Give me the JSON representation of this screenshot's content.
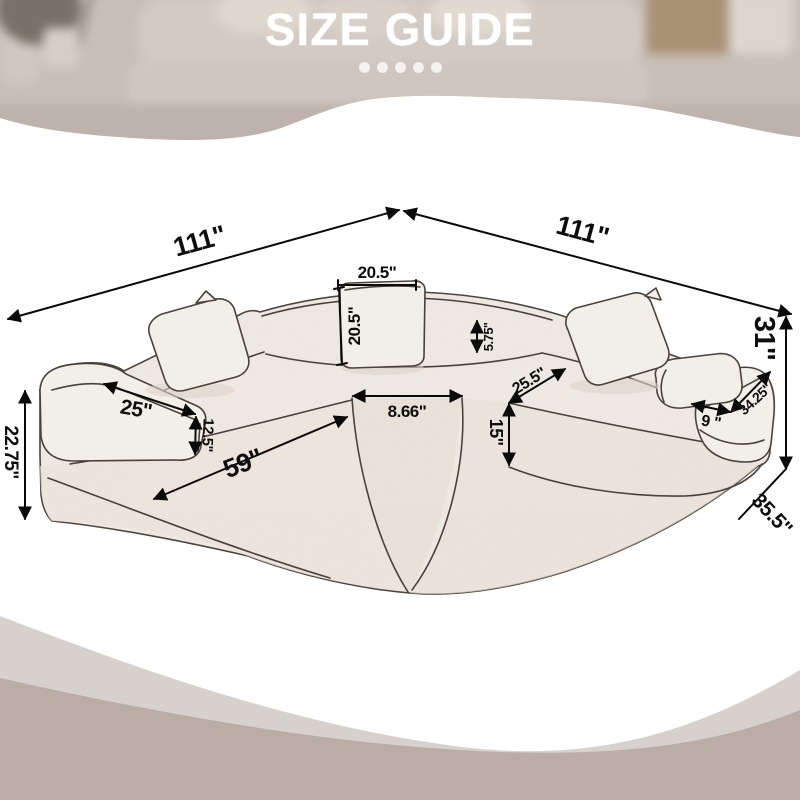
{
  "header": {
    "title": "SIZE GUIDE",
    "dots_count": 5
  },
  "diagram": {
    "dimensions": {
      "left_width": "111\"",
      "right_width": "111\"",
      "pillow_width": "20.5\"",
      "pillow_height": "20.5\"",
      "back_cushion_height": "5.75''",
      "left_armrest_length": "25''",
      "armrest_height": "12.5''",
      "left_seat_front_length": "59''",
      "center_seat_width": "8.66\"",
      "seat_depth": "25.5''",
      "seat_height": "15''",
      "armrest_top_width": "9 \"",
      "right_armrest_length": "34.25''",
      "overall_height": "31''",
      "side_depth": "35.5''",
      "left_overall_height": "22.75''"
    }
  },
  "colors": {
    "photo_base": "#c8bfb9",
    "wave_light": "#d6d1cc",
    "wave_dark": "#bcaca6",
    "sofa_fill": "#f2eee8",
    "sofa_outline": "#4a413c",
    "dimension_line": "#0a0a0a",
    "title_text": "#ffffff"
  }
}
